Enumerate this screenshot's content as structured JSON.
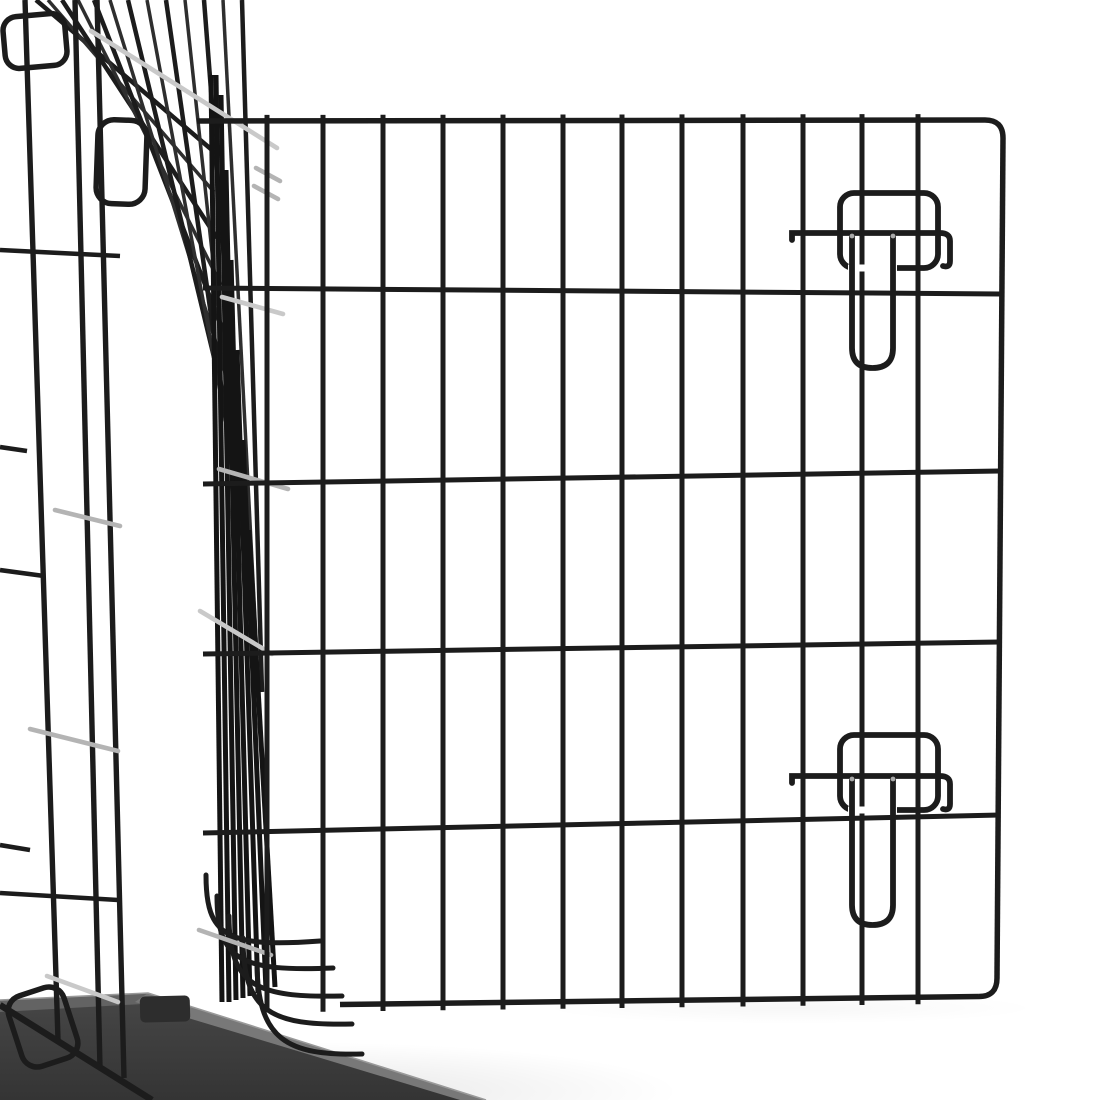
{
  "meta": {
    "subject": "black wire dog crate with open grid door, two slide-bolt latches, black floor tray",
    "background": "#ffffff"
  },
  "palette": {
    "wire": "#1c1c1c",
    "wire_dark": "#141414",
    "wire_soft": "#2e2e2e",
    "tie": "#b4b4b4",
    "tie_light": "#c9c9c9",
    "rivet": "#a8a8a8",
    "tray_face_top": "#474747",
    "tray_face_bottom": "#343434",
    "tray_bevel_top": "#636363",
    "tray_bevel_front": "#787878",
    "tray_notch": "#2d2d2d",
    "tray_highlight": "#9a9a9a",
    "shadow": "#000000"
  },
  "shadows": [
    {
      "cx": 300,
      "cy": 1092,
      "rx": 380,
      "ry": 50,
      "opacity": 0.18
    },
    {
      "cx": 790,
      "cy": 1008,
      "rx": 250,
      "ry": 16,
      "opacity": 0.06
    }
  ],
  "tray": {
    "face": "M0,1000 L148,993 L486,1100 L0,1100 Z",
    "bevel_top": "M0,1000 L148,993 L160,1003 L0,1012 Z",
    "bevel_front": "M148,993 L486,1100 L460,1100 L135,1002 Z",
    "highlight": "M0,1000 L148,993 L486,1100",
    "notch": {
      "x": 140,
      "y": 996,
      "w": 50,
      "h": 26,
      "r": 5,
      "rot": -1.5
    }
  },
  "crate": {
    "side_verticals": [
      [
        25,
        0,
        58,
        1040
      ],
      [
        75,
        0,
        100,
        1068
      ],
      [
        97,
        0,
        124,
        1078
      ]
    ],
    "side_stubs": [
      [
        0,
        250,
        120,
        256
      ],
      [
        0,
        447,
        27,
        451
      ],
      [
        0,
        570,
        44,
        576
      ],
      [
        0,
        845,
        30,
        850
      ],
      [
        0,
        893,
        118,
        900
      ]
    ],
    "loops": [
      {
        "x": 4,
        "y": 15,
        "w": 62,
        "h": 52,
        "r": 14,
        "rot": -5
      },
      {
        "x": 97,
        "y": 120,
        "w": 49,
        "h": 84,
        "r": 16,
        "rot": 2
      },
      {
        "x": 14,
        "y": 990,
        "w": 58,
        "h": 74,
        "r": 16,
        "rot": -18
      }
    ],
    "fan": [
      [
        36,
        0,
        212,
        150
      ],
      [
        48,
        0,
        214,
        192
      ],
      [
        62,
        0,
        217,
        238
      ],
      [
        78,
        0,
        221,
        285
      ],
      [
        94,
        0,
        224,
        333
      ],
      [
        110,
        0,
        228,
        382
      ],
      [
        128,
        0,
        232,
        432
      ],
      [
        147,
        0,
        237,
        482
      ],
      [
        166,
        0,
        242,
        532
      ],
      [
        185,
        0,
        247,
        578
      ],
      [
        204,
        0,
        252,
        620
      ],
      [
        223,
        0,
        257,
        658
      ],
      [
        242,
        0,
        262,
        692
      ]
    ],
    "bundle": [
      [
        211,
        75,
        222,
        1002
      ],
      [
        216,
        75,
        229,
        1002
      ],
      [
        221,
        95,
        236,
        1000
      ],
      [
        226,
        170,
        243,
        998
      ],
      [
        231,
        260,
        250,
        996
      ],
      [
        237,
        350,
        258,
        993
      ],
      [
        243,
        440,
        266,
        990
      ],
      [
        249,
        530,
        275,
        987
      ]
    ],
    "bottom_curves": [
      "M206,875 C206,936 226,948 320,941",
      "M217,896 C217,960 240,972 333,968",
      "M229,916 C229,986 256,998 342,996",
      "M243,938 C243,1012 271,1026 352,1024",
      "M257,962 C257,1040 287,1056 362,1054"
    ],
    "bottom_rail": [
      0,
      1005,
      152,
      1100
    ]
  },
  "ties": [
    [
      91,
      31,
      277,
      148
    ],
    [
      256,
      168,
      280,
      181
    ],
    [
      254,
      186,
      278,
      199
    ],
    [
      222,
      297,
      283,
      314
    ],
    [
      219,
      469,
      288,
      489
    ],
    [
      55,
      510,
      120,
      526
    ],
    [
      200,
      611,
      272,
      654
    ],
    [
      30,
      729,
      118,
      751
    ],
    [
      199,
      930,
      271,
      955
    ],
    [
      47,
      976,
      118,
      1002
    ]
  ],
  "door": {
    "top_rail": {
      "x1": 197,
      "y1": 121,
      "x2": 985,
      "y2": 120
    },
    "top_corner": "M985,120 Q1003,120 1003,138",
    "right_edge": [
      1003,
      138,
      997,
      978
    ],
    "bottom_corner": "M997,978 Q997,996.5 979,996.5",
    "bottom_rail": {
      "x1": 340,
      "y1": 1004.5,
      "x2": 979,
      "y2": 996.5
    },
    "verticals": [
      267,
      323,
      383,
      443,
      503,
      563,
      622,
      682,
      743,
      803,
      862,
      918
    ],
    "vertical_stub_top": 6,
    "vertical_stub_bottom": 7,
    "horizontals": [
      {
        "x1": 203,
        "y1": 288,
        "x2": 1000,
        "y2": 294
      },
      {
        "x1": 203,
        "y1": 484,
        "x2": 1000,
        "y2": 471
      },
      {
        "x1": 203,
        "y1": 654,
        "x2": 1000,
        "y2": 642
      },
      {
        "x1": 203,
        "y1": 833,
        "x2": 1000,
        "y2": 815
      }
    ]
  },
  "latches": [
    {
      "keeper": {
        "x": 840,
        "y": 193,
        "w": 98,
        "h": 75,
        "r": 14
      },
      "keeper_gap": [
        848,
        268,
        897,
        268
      ],
      "bar": "M792,240 L792,233 L940,233 Q950,233 950,241 L950,261 Q950,268 943,266",
      "pin": "M852,233 L852,348 Q852,368 872.5,368 Q893,368 893,348 L893,233",
      "rivets": [
        [
          852,
          236
        ],
        [
          893,
          236
        ]
      ]
    },
    {
      "keeper": {
        "x": 840,
        "y": 735,
        "w": 98,
        "h": 75,
        "r": 14
      },
      "keeper_gap": [
        848,
        810,
        897,
        810
      ],
      "bar": "M792,783 L792,776 L940,776 Q950,776 950,784 L950,804 Q950,811 943,809",
      "pin": "M852,776 L852,905 Q852,925 872.5,925 Q893,925 893,905 L893,776",
      "rivets": [
        [
          852,
          779
        ],
        [
          893,
          779
        ]
      ]
    }
  ]
}
